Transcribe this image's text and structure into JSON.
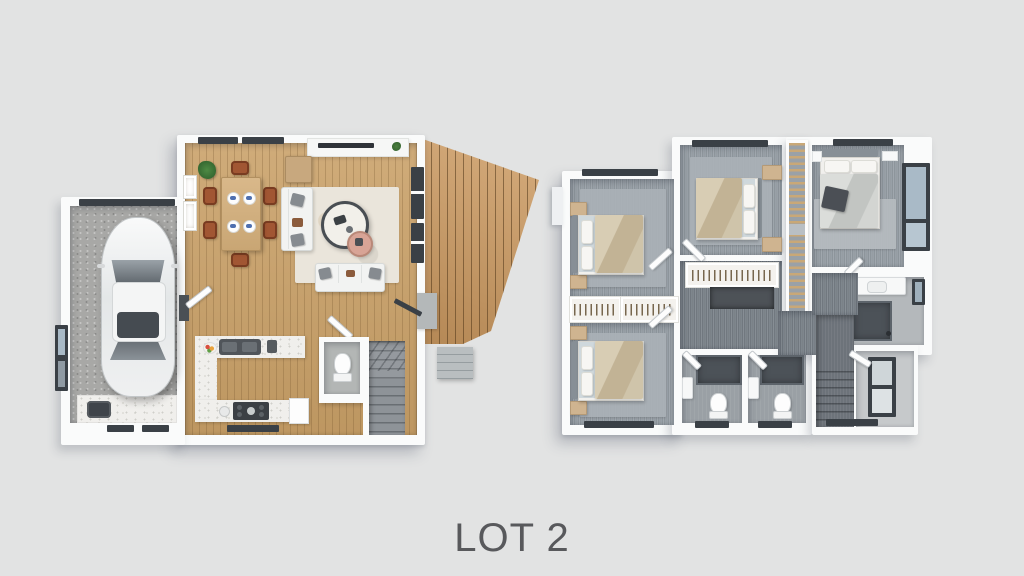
{
  "caption": {
    "label": "LOT 2"
  },
  "palette": {
    "background": "#e2e3e3",
    "wall": "#fafbfb",
    "wood_floor": "#c9a067",
    "deck_wood": "#cd9a60",
    "carpet": "#98a0a7",
    "hall_carpet": "#7e868d",
    "rug_gray": "#aab1b7",
    "rug_cream": "#eae5db",
    "garage_floor": "#a8a8a6",
    "window_frame": "#3a4046",
    "window_glass": "#a9bac7",
    "marble": "#f0efec",
    "chair_brown": "#a15633",
    "nightstand_tan": "#cfb490",
    "duvet_beige": "#c9bca3",
    "shower_dark": "#4c5258",
    "stair_carpet": "#8e9398",
    "caption_text": "#58595c"
  }
}
